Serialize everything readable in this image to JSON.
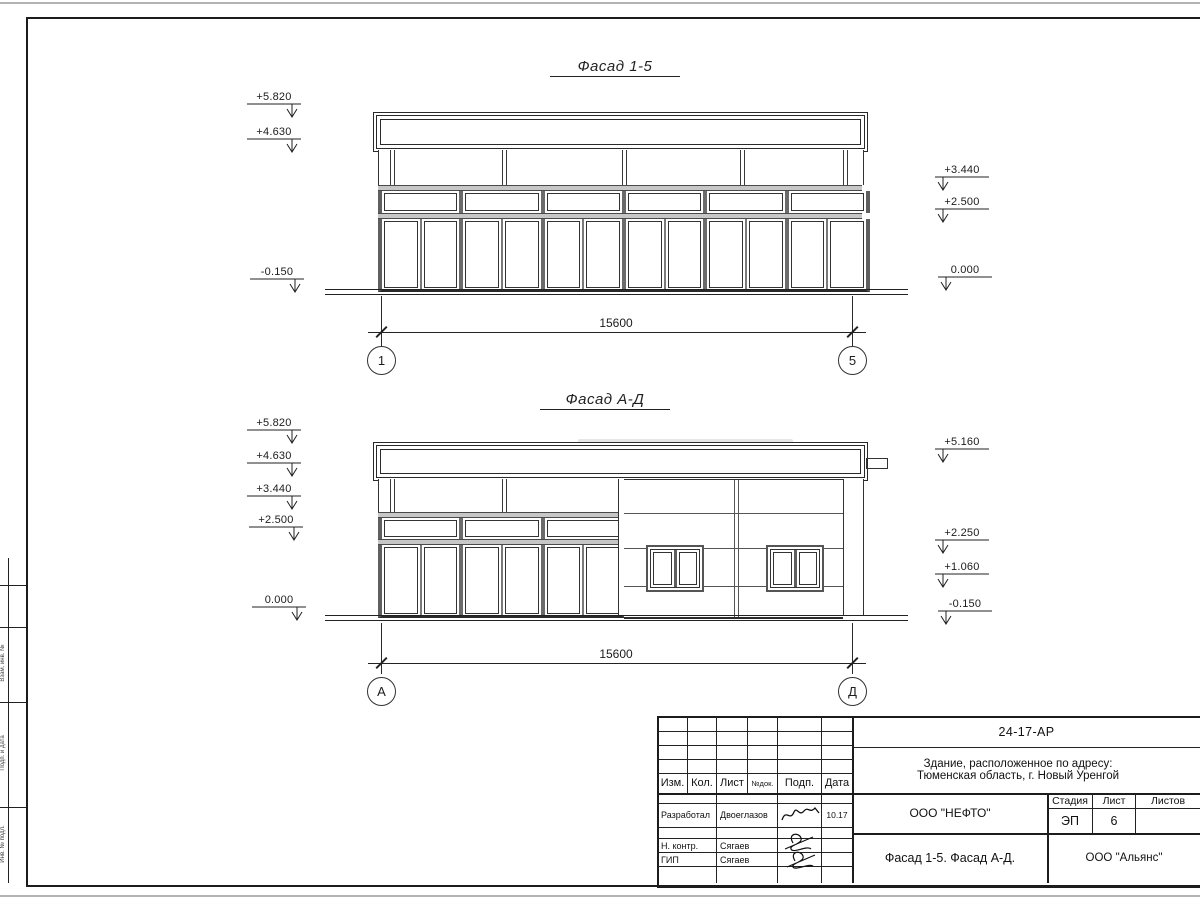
{
  "facade1": {
    "title": "Фасад 1-5",
    "dim": "15600",
    "axis_left": "1",
    "axis_right": "5",
    "marks_left": [
      "+5.820",
      "+4.630",
      "-0.150"
    ],
    "marks_right": [
      "+3.440",
      "+2.500",
      "0.000"
    ]
  },
  "facade2": {
    "title": "Фасад А-Д",
    "dim": "15600",
    "axis_left": "А",
    "axis_right": "Д",
    "marks_left": [
      "+5.820",
      "+4.630",
      "+3.440",
      "+2.500",
      "0.000"
    ],
    "marks_right": [
      "+5.160",
      "+2.250",
      "+1.060",
      "-0.150"
    ]
  },
  "titleblock": {
    "doc_code": "24-17-АР",
    "address_line1": "Здание, расположенное по адресу:",
    "address_line2": "Тюменская область, г. Новый Уренгой",
    "columns": {
      "izm": "Изм.",
      "kol": "Кол.",
      "list": "Лист",
      "ndoc": "№док.",
      "podp": "Подп.",
      "data": "Дата"
    },
    "rows": [
      {
        "role": "Разработал",
        "name": "Двоеглазов",
        "date": "10.17"
      },
      {
        "role": "Н. контр.",
        "name": "Сягаев",
        "date": ""
      },
      {
        "role": "ГИП",
        "name": "Сягаев",
        "date": ""
      }
    ],
    "contractor": "ООО \"НЕФТО\"",
    "stage_label": "Стадия",
    "sheet_label": "Лист",
    "sheets_label": "Листов",
    "stage": "ЭП",
    "sheet_no": "6",
    "drawing_title": "Фасад 1-5. Фасад А-Д.",
    "org": "ООО \"Альянс\""
  },
  "margin_labels": [
    "Взам. инв. №",
    "Подп. и дата",
    "Инв. № подл."
  ]
}
